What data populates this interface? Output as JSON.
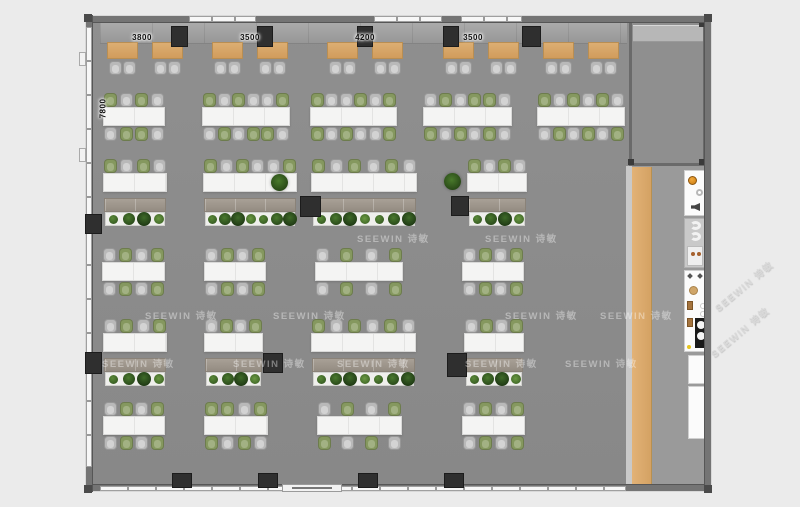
{
  "watermark": {
    "text": "SEEWIN 诗敏"
  },
  "dimension_labels": {
    "top": [
      {
        "text": "3800",
        "x": 142
      },
      {
        "text": "3500",
        "x": 250
      },
      {
        "text": "4200",
        "x": 365
      },
      {
        "text": "3500",
        "x": 473
      }
    ],
    "side": {
      "text": "7800",
      "x": 88,
      "y": 104
    }
  },
  "palette": {
    "floor": "#8c8c8c",
    "wall": "#747474",
    "desk_wood": "#d7a368",
    "chair_green": "#85985f",
    "chair_grey": "#b9b9b9",
    "table_white": "#f4f4f3",
    "plant_green": "#3c6626",
    "column_dark": "#2f2f2f",
    "knob_orange": "#e8921e",
    "wood_strip": "#ddab6f"
  },
  "layout": {
    "training_desks_x": [
      107,
      152,
      212,
      257,
      327,
      372,
      443,
      488,
      543,
      588
    ],
    "clusters": [
      {
        "x": 103,
        "y": 93,
        "w": 62,
        "top": [
          "g",
          "G",
          "g",
          "G"
        ],
        "bot": [
          "G",
          "g",
          "g",
          "G"
        ]
      },
      {
        "x": 202,
        "y": 93,
        "w": 88,
        "top": [
          "g",
          "G",
          "g",
          "G",
          "G",
          "g"
        ],
        "bot": [
          "G",
          "g",
          "G",
          "g",
          "g",
          "G"
        ]
      },
      {
        "x": 310,
        "y": 93,
        "w": 87,
        "top": [
          "g",
          "G",
          "G",
          "g",
          "G",
          "g"
        ],
        "bot": [
          "g",
          "G",
          "g",
          "G",
          "G",
          "g"
        ]
      },
      {
        "x": 423,
        "y": 93,
        "w": 89,
        "top": [
          "G",
          "g",
          "G",
          "g",
          "g",
          "G"
        ],
        "bot": [
          "g",
          "G",
          "g",
          "G",
          "g",
          "G"
        ]
      },
      {
        "x": 537,
        "y": 93,
        "w": 88,
        "top": [
          "g",
          "G",
          "g",
          "G",
          "g",
          "G"
        ],
        "bot": [
          "G",
          "g",
          "G",
          "g",
          "G",
          "g"
        ]
      },
      {
        "x": 102,
        "y": 248,
        "w": 63,
        "top": [
          "G",
          "g",
          "G",
          "g"
        ],
        "bot": [
          "G",
          "g",
          "G",
          "g"
        ]
      },
      {
        "x": 204,
        "y": 248,
        "w": 62,
        "top": [
          "G",
          "g",
          "G",
          "g"
        ],
        "bot": [
          "G",
          "g",
          "G",
          "g"
        ]
      },
      {
        "x": 315,
        "y": 248,
        "w": 88,
        "top": [
          "G",
          "g",
          "G",
          "g"
        ],
        "bot": [
          "G",
          "g",
          "G",
          "g"
        ]
      },
      {
        "x": 462,
        "y": 248,
        "w": 62,
        "top": [
          "G",
          "g",
          "G",
          "g"
        ],
        "bot": [
          "G",
          "g",
          "G",
          "g"
        ]
      },
      {
        "x": 103,
        "y": 402,
        "w": 62,
        "top": [
          "G",
          "g",
          "G",
          "g"
        ],
        "bot": [
          "G",
          "g",
          "G",
          "g"
        ]
      },
      {
        "x": 204,
        "y": 402,
        "w": 64,
        "top": [
          "g",
          "g",
          "G",
          "g"
        ],
        "bot": [
          "g",
          "G",
          "g",
          "G"
        ]
      },
      {
        "x": 317,
        "y": 402,
        "w": 85,
        "top": [
          "G",
          "g",
          "G",
          "g"
        ],
        "bot": [
          "g",
          "G",
          "g",
          "G"
        ]
      },
      {
        "x": 462,
        "y": 402,
        "w": 63,
        "top": [
          "G",
          "g",
          "G",
          "g"
        ],
        "bot": [
          "G",
          "g",
          "G",
          "g"
        ]
      }
    ],
    "desk_rows": [
      {
        "x": 103,
        "y": 159,
        "w": 64,
        "chairs": [
          "g",
          "G",
          "g",
          "G"
        ],
        "plants": 4
      },
      {
        "x": 203,
        "y": 159,
        "w": 94,
        "chairs": [
          "g",
          "G",
          "g",
          "G",
          "G",
          "g"
        ],
        "plants": 7
      },
      {
        "x": 311,
        "y": 159,
        "w": 106,
        "chairs": [
          "g",
          "G",
          "g",
          "G",
          "g",
          "G"
        ],
        "plants": 7
      },
      {
        "x": 467,
        "y": 159,
        "w": 60,
        "chairs": [
          "g",
          "G",
          "g",
          "G"
        ],
        "plants": 4
      },
      {
        "x": 103,
        "y": 319,
        "w": 64,
        "chairs": [
          "G",
          "g",
          "G",
          "g"
        ],
        "plants": 4
      },
      {
        "x": 204,
        "y": 319,
        "w": 59,
        "chairs": [
          "G",
          "g",
          "G",
          "g"
        ],
        "plants": 4
      },
      {
        "x": 311,
        "y": 319,
        "w": 105,
        "chairs": [
          "g",
          "G",
          "g",
          "G",
          "g",
          "G"
        ],
        "plants": 7
      },
      {
        "x": 464,
        "y": 319,
        "w": 60,
        "chairs": [
          "G",
          "g",
          "G",
          "g"
        ],
        "plants": 4
      }
    ],
    "columns": [
      [
        171,
        26,
        17,
        21
      ],
      [
        257,
        26,
        16,
        21
      ],
      [
        357,
        26,
        16,
        21
      ],
      [
        443,
        26,
        16,
        21
      ],
      [
        522,
        26,
        19,
        21
      ],
      [
        172,
        473,
        20,
        15
      ],
      [
        258,
        473,
        20,
        15
      ],
      [
        358,
        473,
        20,
        15
      ],
      [
        444,
        473,
        20,
        15
      ],
      [
        85,
        214,
        17,
        20
      ],
      [
        85,
        352,
        17,
        22
      ],
      [
        300,
        196,
        21,
        21
      ],
      [
        451,
        196,
        18,
        20
      ],
      [
        263,
        353,
        20,
        20
      ],
      [
        447,
        353,
        20,
        24
      ]
    ],
    "potted_plants": [
      [
        271,
        174
      ],
      [
        444,
        173
      ]
    ],
    "watermarks": [
      {
        "x": 357,
        "y": 231
      },
      {
        "x": 485,
        "y": 231
      },
      {
        "x": 145,
        "y": 308
      },
      {
        "x": 273,
        "y": 308
      },
      {
        "x": 505,
        "y": 308
      },
      {
        "x": 600,
        "y": 308
      },
      {
        "x": 102,
        "y": 356
      },
      {
        "x": 233,
        "y": 356
      },
      {
        "x": 337,
        "y": 356
      },
      {
        "x": 465,
        "y": 356
      },
      {
        "x": 565,
        "y": 356
      },
      {
        "x": 716,
        "y": 302,
        "r": -40
      },
      {
        "x": 712,
        "y": 348,
        "r": -40
      }
    ]
  }
}
